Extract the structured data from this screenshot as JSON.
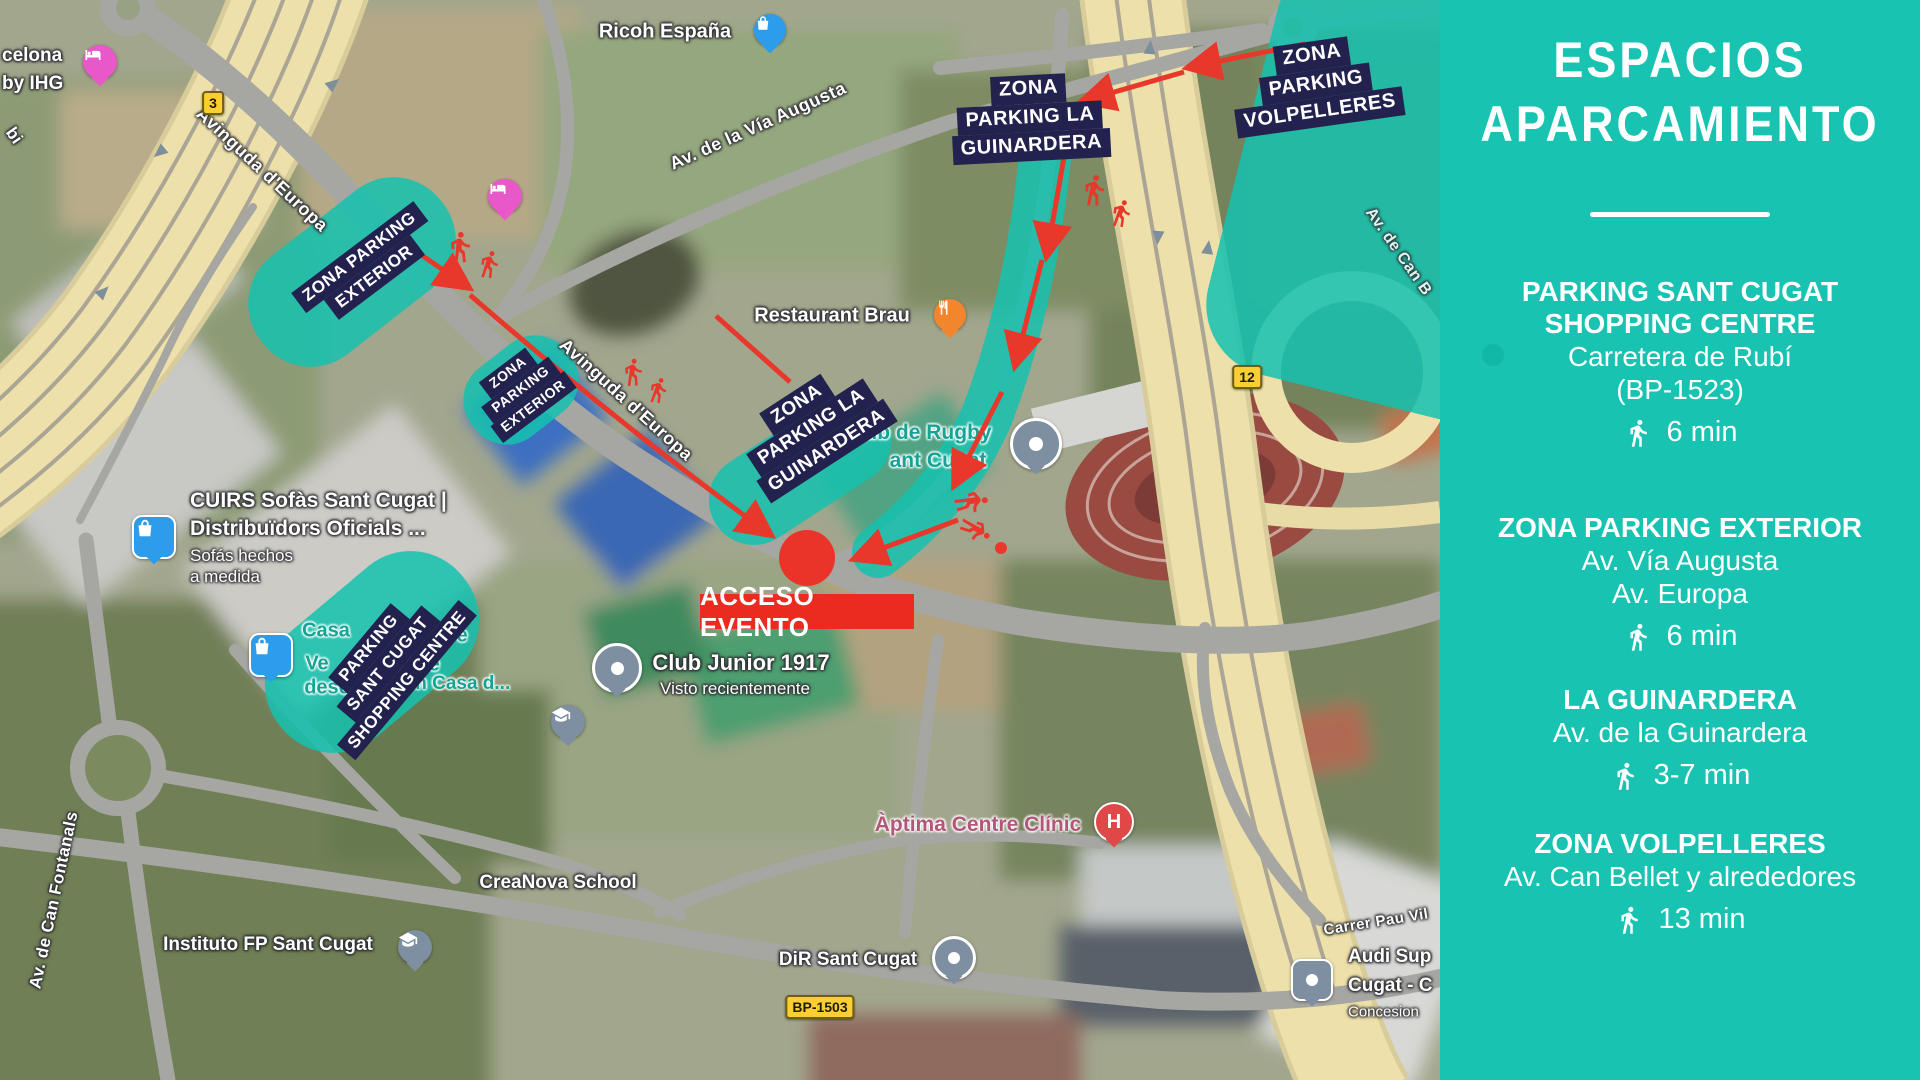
{
  "sidebar": {
    "title_lines": [
      "ESPACIOS",
      "APARCAMIENTO"
    ],
    "entries": [
      {
        "name_lines": [
          "PARKING SANT CUGAT",
          "SHOPPING CENTRE"
        ],
        "address_lines": [
          "Carretera de Rubí",
          "(BP-1523)"
        ],
        "walk_time": "6 min"
      },
      {
        "name_lines": [
          "ZONA PARKING EXTERIOR"
        ],
        "address_lines": [
          "Av. Vía Augusta",
          "Av. Europa"
        ],
        "walk_time": "6 min"
      },
      {
        "name_lines": [
          "LA GUINARDERA"
        ],
        "address_lines": [
          "Av. de la Guinardera"
        ],
        "walk_time": "3-7 min"
      },
      {
        "name_lines": [
          "ZONA VOLPELLERES"
        ],
        "address_lines": [
          "Av. Can Bellet y alrededores"
        ],
        "walk_time": "13 min"
      }
    ],
    "colors": {
      "background": "#18C3B1",
      "text": "#FFFFFF"
    }
  },
  "map": {
    "access_marker": {
      "label": "ACCESO EVENTO",
      "color": "#EC2B20"
    },
    "overlay_zone_color": "#16C2AF",
    "navy_label_color": "#23224E",
    "arrow_color": "#E8382B",
    "zone_labels": {
      "guinardera_top": {
        "lines": [
          "ZONA",
          "PARKING LA",
          "GUINARDERA"
        ]
      },
      "volpelleres": {
        "lines": [
          "ZONA",
          "PARKING",
          "VOLPELLERES"
        ]
      },
      "exterior_main": {
        "lines": [
          "ZONA PARKING",
          "EXTERIOR"
        ]
      },
      "exterior_small": {
        "lines": [
          "ZONA",
          "PARKING",
          "EXTERIOR"
        ]
      },
      "guinardera_road": {
        "lines": [
          "ZONA",
          "PARKING LA",
          "GUINARDERA"
        ]
      },
      "shopping_centre": {
        "lines": [
          "PARKING",
          "SANT CUGAT",
          "SHOPPING CENTRE"
        ]
      }
    },
    "route_badges": {
      "b3": "3",
      "b12": "12",
      "bp1503": "BP-1503"
    },
    "road_labels": {
      "europa_1": "Avinguda d'Europa",
      "europa_2": "Avinguda d'Europa",
      "via_augusta": "Av. de la Vía Augusta",
      "can_fontanals": "Av. de Can Fontanals",
      "pau_vila": "Carrer Pau Vil",
      "can_bellet": "Av. de Can B",
      "bi": "bi"
    },
    "pois": {
      "hotel_partial": {
        "lines": [
          "celona",
          "by IHG"
        ]
      },
      "ricoh": "Ricoh España",
      "restaurant": "Restaurant Brau",
      "rugby": {
        "lines": [
          "ub de Rugby",
          "ant Cugat"
        ]
      },
      "cuirs": {
        "lines": [
          "CUIRS Sofàs Sant Cugat |",
          "Distribuïdors Oficials ..."
        ],
        "sub_lines": [
          "Sofás hechos",
          "a medida"
        ]
      },
      "casa": {
        "fragments": [
          "Casa",
          "bre",
          "Ve",
          "5% de",
          "desc",
          "o en Casa d..."
        ]
      },
      "club_junior": {
        "name": "Club Junior 1917",
        "sub": "Visto recientemente"
      },
      "aptima": "Àptima Centre Clínic",
      "hospital_letter": "H",
      "creanova": "CreaNova School",
      "instituto": "Instituto FP Sant Cugat",
      "dir": "DiR Sant Cugat",
      "audi": {
        "lines": [
          "Audi Sup",
          "Cugat - C",
          "Concesion"
        ]
      }
    }
  }
}
